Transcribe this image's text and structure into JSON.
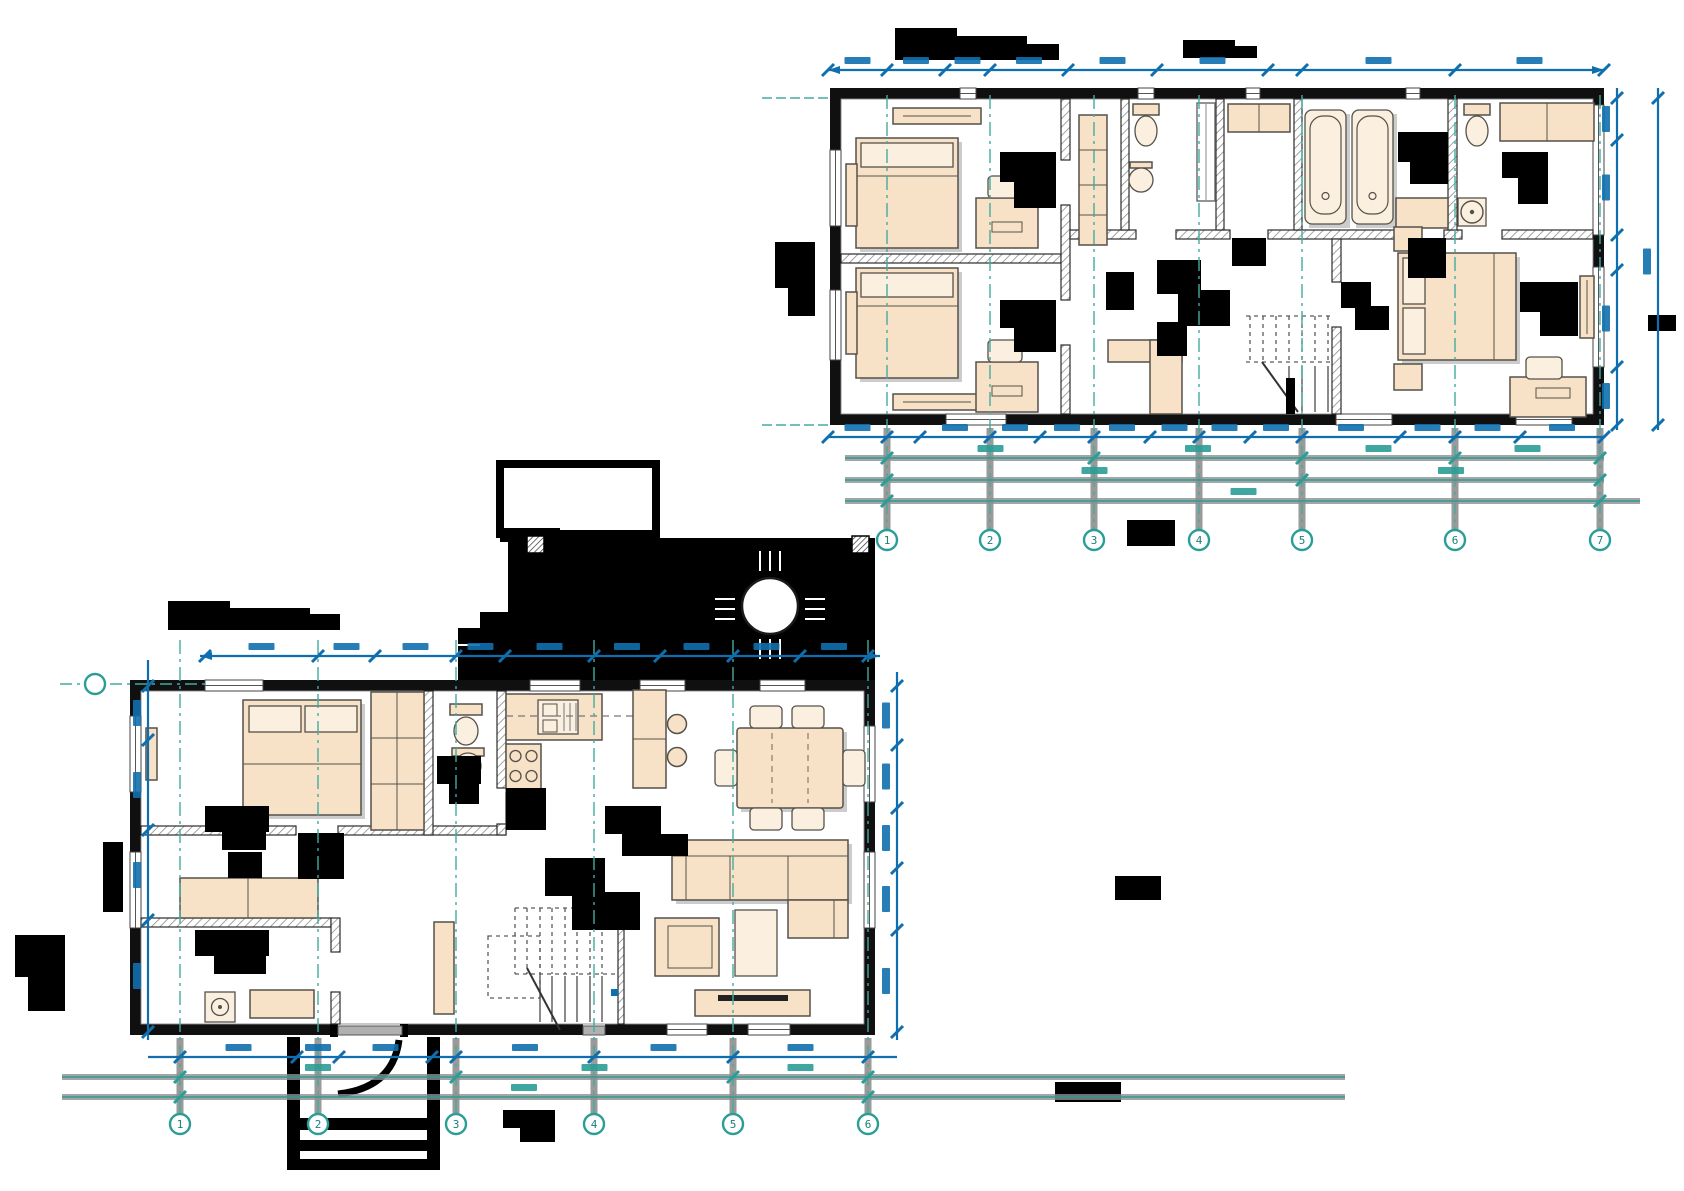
{
  "document": {
    "kind": "architectural floor plan drawing",
    "description": "Two furnished floor plans of a two-storey house. All drawing titles, room labels and most dimension values are blacked out (redacted) or too small to read.",
    "background": "#ffffff",
    "upper_plan_aria": "Upper floor plan: two bedrooms with desks, hallway with wardrobes, WC, closet, bathroom with two bathtubs, second WC, master bedroom, staircase",
    "lower_plan_aria": "Ground floor plan: bedroom, bathroom, kitchen, living-dining room, hallway with staircase, utility rooms, terrace with round table, entry porch"
  },
  "colors": {
    "dimension_blue": "#0f6fae",
    "grid_teal": "#2a9d96",
    "centerline_teal": "#43ab9f",
    "furniture_fill": "#f7e2c8",
    "furniture_fill_light": "#fbf0df",
    "furniture_stroke": "#55514a",
    "shadow_gray": "#9a9a9a",
    "wall_black": "#101010",
    "redaction_black": "#000000"
  },
  "upper_plan": {
    "title": {
      "text": "",
      "redacted": true
    },
    "rooms": [
      {
        "name": "bedroom-1",
        "furniture": [
          "single bed",
          "wall shelf",
          "desk",
          "chair",
          "radiator"
        ]
      },
      {
        "name": "bedroom-2",
        "furniture": [
          "single bed",
          "wall shelf",
          "desk",
          "chair",
          "radiator"
        ]
      },
      {
        "name": "hallway",
        "furniture": [
          "tall cabinet",
          "L-shaped wardrobe",
          "staircase"
        ]
      },
      {
        "name": "wc-1",
        "furniture": [
          "toilet",
          "round washbasin",
          "shower screen"
        ]
      },
      {
        "name": "closet",
        "furniture": [
          "shelf unit"
        ]
      },
      {
        "name": "bathroom",
        "furniture": [
          "bathtub",
          "bathtub",
          "vanity counter"
        ]
      },
      {
        "name": "wc-2",
        "furniture": [
          "toilet",
          "washbasin on stand",
          "wardrobe"
        ]
      },
      {
        "name": "master-bedroom",
        "furniture": [
          "double bed",
          "nightstand",
          "nightstand",
          "desk",
          "chair",
          "radiator"
        ]
      }
    ]
  },
  "lower_plan": {
    "title": {
      "text": "",
      "redacted": true
    },
    "rooms": [
      {
        "name": "bedroom",
        "furniture": [
          "double bed",
          "wardrobe",
          "radiator"
        ]
      },
      {
        "name": "bathroom",
        "furniture": [
          "toilet",
          "washbasin"
        ]
      },
      {
        "name": "kitchen",
        "furniture": [
          "counter with sink",
          "4-burner cooktop",
          "base cabinet",
          "island peninsula",
          "bar stool",
          "bar stool"
        ]
      },
      {
        "name": "living-dining-room",
        "furniture": [
          "dining table",
          "six chairs",
          "corner sofa",
          "armchair",
          "coffee table",
          "TV stand"
        ]
      },
      {
        "name": "hallway",
        "furniture": [
          "staircase",
          "door leaf"
        ]
      },
      {
        "name": "utility-room",
        "furniture": [
          "washing machine",
          "counter",
          "bench"
        ]
      },
      {
        "name": "terrace",
        "furniture": [
          "round table",
          "four chairs",
          "two posts",
          "canopy outline",
          "outdoor steps"
        ]
      },
      {
        "name": "entry-porch",
        "furniture": [
          "three steps"
        ]
      }
    ]
  },
  "grid": {
    "upper": {
      "xs": [
        887,
        990,
        1094,
        1199,
        1302,
        1455,
        1600
      ],
      "labels": [
        "1",
        "2",
        "3",
        "4",
        "5",
        "6",
        "7"
      ],
      "y_top": 95,
      "y_bottom": 530,
      "bubble_y": 540,
      "stem_top": 428
    },
    "lower": {
      "xs": [
        180,
        318,
        456,
        594,
        733,
        868
      ],
      "labels": [
        "1",
        "2",
        "3",
        "4",
        "5",
        "6"
      ],
      "y_top": 640,
      "y_bottom": 1114,
      "bubble_y": 1124,
      "stem_top": 1038,
      "row": {
        "x": 95,
        "y": 684,
        "line_x1": 60,
        "line_x2": 205,
        "label": ""
      }
    }
  },
  "dimensions": {
    "values_legible": false,
    "lines": [
      {
        "plan": "upper",
        "orient": "h",
        "y": 70,
        "x1": 828,
        "x2": 1604,
        "color": "blue",
        "arrows": true,
        "ticks": [
          828,
          887,
          945,
          990,
          1068,
          1157,
          1268,
          1302,
          1455,
          1604
        ]
      },
      {
        "plan": "upper",
        "orient": "h",
        "y": 437,
        "x1": 828,
        "x2": 1604,
        "color": "blue",
        "ticks": [
          828,
          887,
          920,
          990,
          1040,
          1094,
          1150,
          1199,
          1250,
          1302,
          1400,
          1455,
          1520,
          1604
        ]
      },
      {
        "plan": "upper",
        "orient": "h",
        "y": 458,
        "x1": 845,
        "x2": 1604,
        "color": "teal",
        "gray": true,
        "ticks": [
          887,
          1094,
          1302,
          1455,
          1600
        ]
      },
      {
        "plan": "upper",
        "orient": "h",
        "y": 480,
        "x1": 845,
        "x2": 1604,
        "color": "teal",
        "gray": true,
        "ticks": [
          887,
          1302,
          1600
        ]
      },
      {
        "plan": "upper",
        "orient": "h",
        "y": 501,
        "x1": 845,
        "x2": 1640,
        "color": "teal",
        "gray": true,
        "ticks": [
          887,
          1600
        ]
      },
      {
        "plan": "upper",
        "orient": "v",
        "x": 1617,
        "y1": 88,
        "y2": 430,
        "color": "blue",
        "ticks": [
          98,
          140,
          235,
          270,
          367,
          425
        ]
      },
      {
        "plan": "upper",
        "orient": "v",
        "x": 1658,
        "y1": 88,
        "y2": 430,
        "color": "blue",
        "ticks": [
          98,
          425
        ]
      },
      {
        "plan": "lower",
        "orient": "h",
        "y": 656,
        "x1": 200,
        "x2": 880,
        "color": "blue",
        "arrows": true,
        "ticks": [
          205,
          318,
          375,
          456,
          505,
          594,
          660,
          733,
          800,
          868
        ]
      },
      {
        "plan": "lower",
        "orient": "v",
        "x": 148,
        "y1": 660,
        "y2": 1040,
        "color": "blue",
        "ticks": [
          686,
          740,
          830,
          920,
          1032
        ]
      },
      {
        "plan": "lower",
        "orient": "v",
        "x": 897,
        "y1": 672,
        "y2": 1040,
        "color": "blue",
        "ticks": [
          686,
          745,
          808,
          868,
          930,
          1032
        ]
      },
      {
        "plan": "lower",
        "orient": "h",
        "y": 1057,
        "x1": 148,
        "x2": 897,
        "color": "blue",
        "ticks": [
          180,
          297,
          339,
          432,
          456,
          594,
          733,
          868
        ]
      },
      {
        "plan": "lower",
        "orient": "h",
        "y": 1077,
        "x1": 62,
        "x2": 1345,
        "color": "teal",
        "gray": true,
        "ticks": [
          180,
          456,
          733,
          868
        ]
      },
      {
        "plan": "lower",
        "orient": "h",
        "y": 1097,
        "x1": 62,
        "x2": 1345,
        "color": "teal",
        "gray": true,
        "ticks": [
          180,
          868
        ]
      }
    ]
  }
}
